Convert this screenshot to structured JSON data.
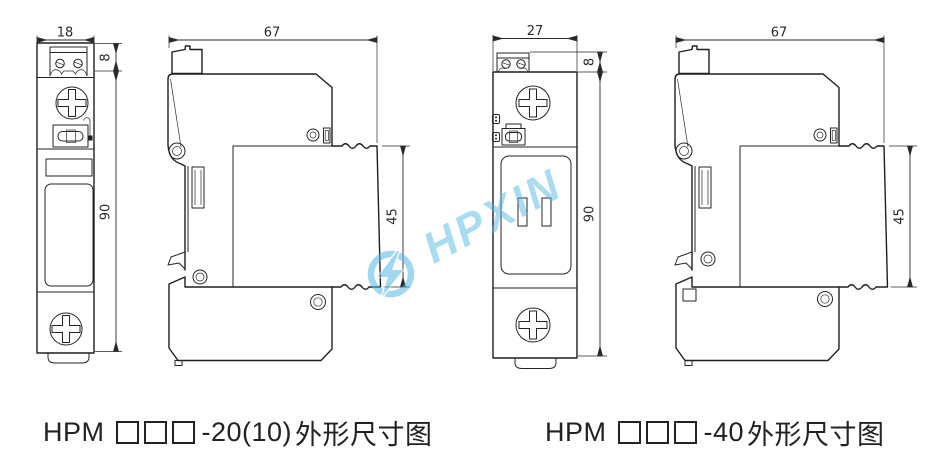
{
  "watermark": {
    "text": "HPXIN",
    "color": "#55B8E4"
  },
  "figures": [
    {
      "id": "hpm-20",
      "caption": {
        "prefix": "HPM",
        "suffix": "-20(10)",
        "label": "外形尺寸图"
      },
      "front": {
        "width": "18",
        "terminal_height": "8",
        "height": "90"
      },
      "side": {
        "depth": "67",
        "module_height": "45"
      }
    },
    {
      "id": "hpm-40",
      "caption": {
        "prefix": "HPM",
        "suffix": "-40",
        "label": "外形尺寸图"
      },
      "front": {
        "width": "27",
        "terminal_height": "8",
        "height": "90"
      },
      "side": {
        "depth": "67",
        "module_height": "45"
      }
    }
  ]
}
